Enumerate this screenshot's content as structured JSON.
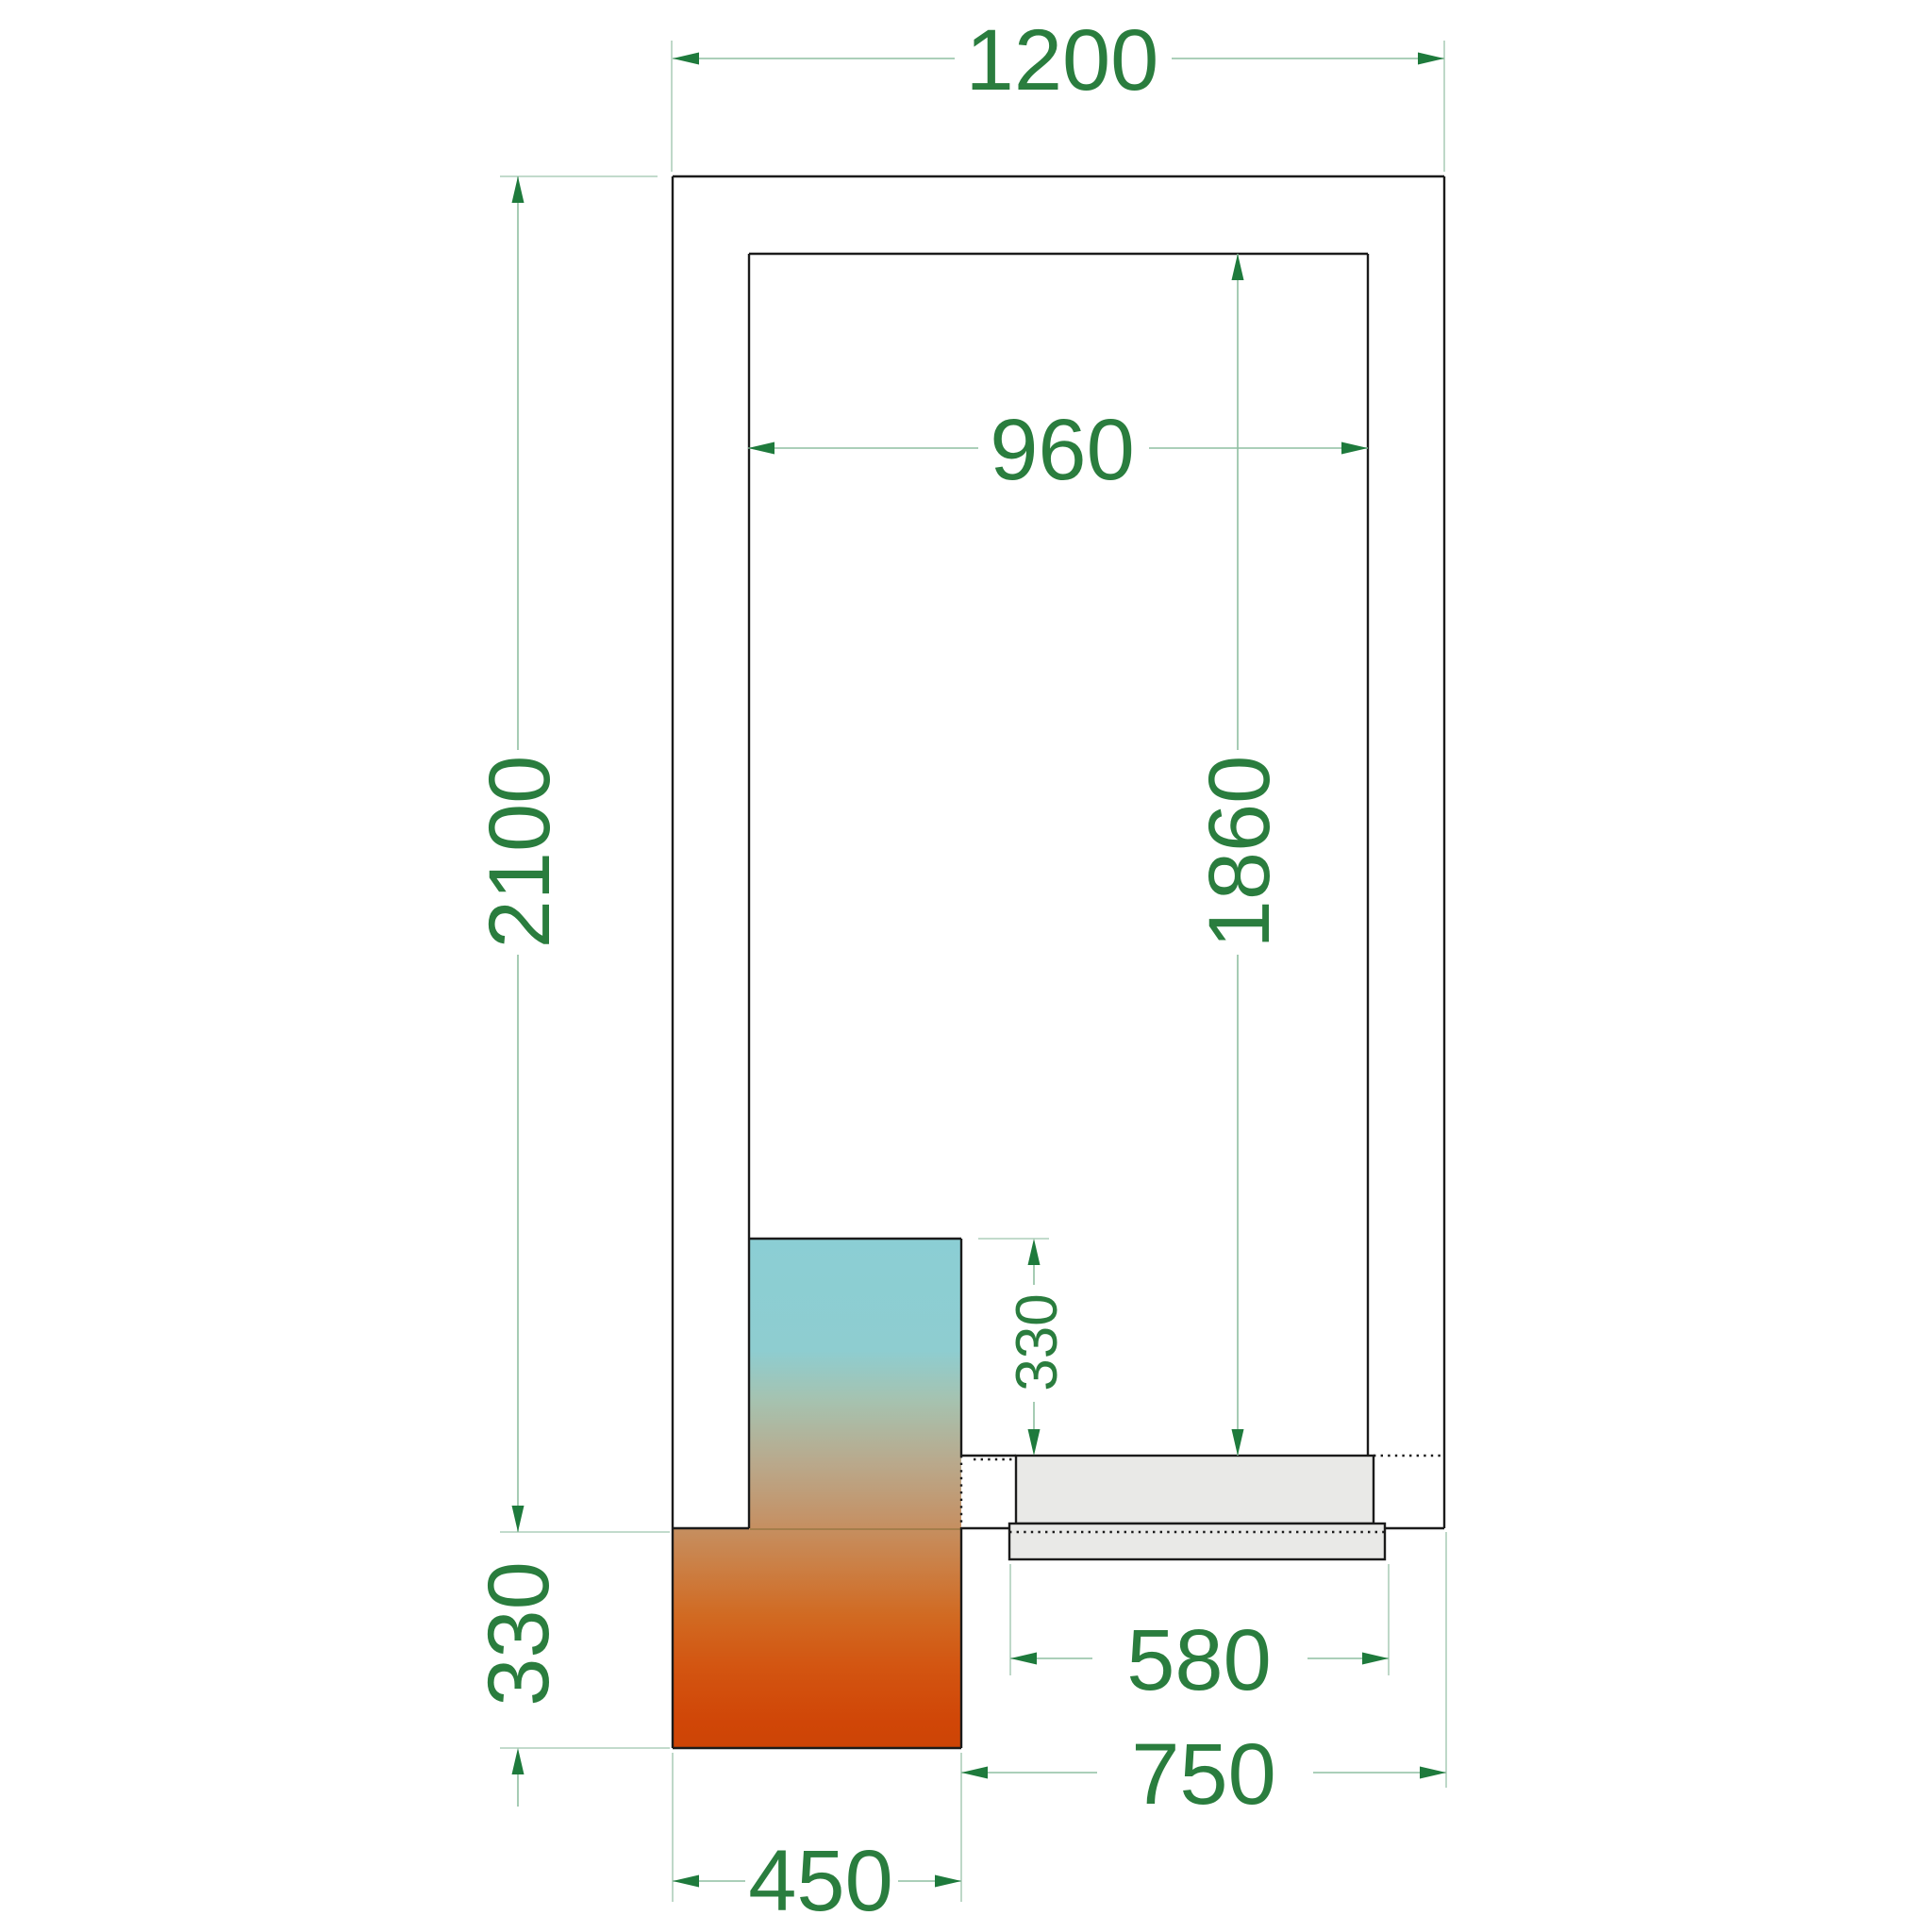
{
  "drawing": {
    "type": "cold-room-floor-plan",
    "dimensions": {
      "outer_width": "1200",
      "outer_depth": "2100",
      "inner_width": "960",
      "inner_depth": "1860",
      "unit_inside_depth": "330",
      "unit_outside_depth": "330",
      "unit_width": "450",
      "door_width": "580",
      "door_span_from_unit": "750"
    },
    "colors": {
      "dimension_text": "#2a7d3e",
      "dimension_arrow": "#1e7a3c",
      "dimension_line": "#8fbfa2",
      "extension_line": "#aecfbb",
      "outline": "#1b1b1b",
      "door_fill": "#e9e9e7",
      "unit_gradient_cold_top": "#8bced4",
      "unit_gradient_warm_bottom": "#cd4405"
    }
  }
}
